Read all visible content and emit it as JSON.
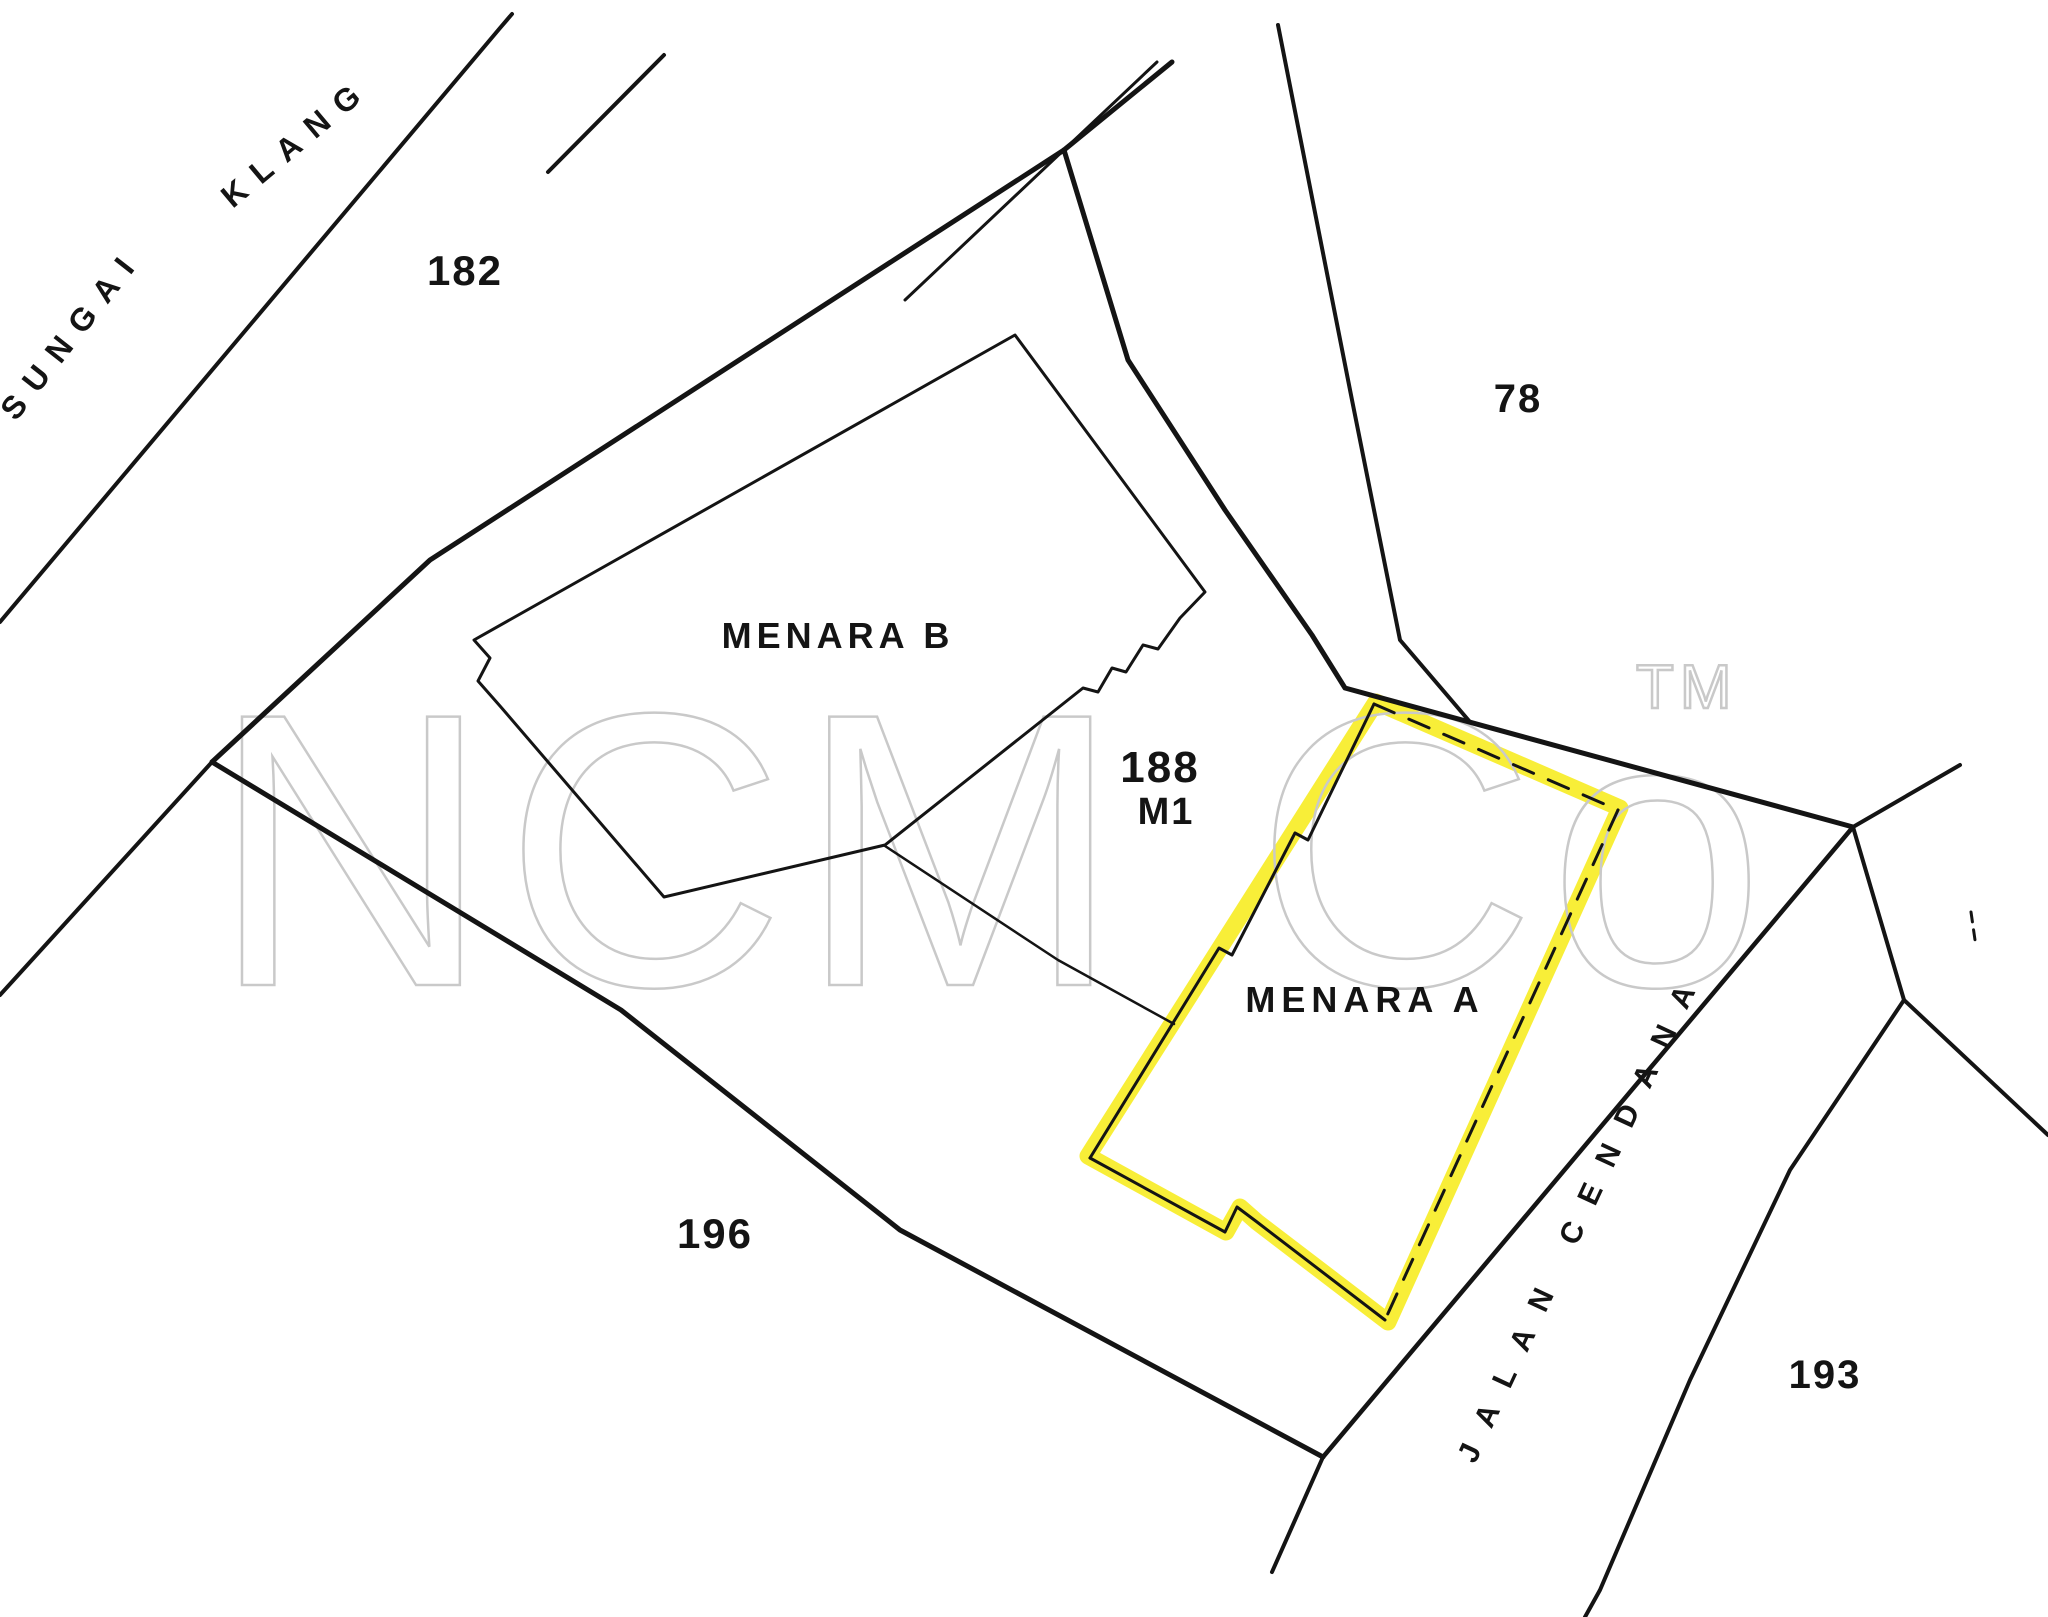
{
  "canvas": {
    "width": 2048,
    "height": 1617,
    "background": "#ffffff",
    "line_color": "#141414",
    "highlight_color": "#f7ec1c",
    "watermark_color": "#c9c9c9"
  },
  "watermark": {
    "text": "NCM Co",
    "tm_text": "TM"
  },
  "map": {
    "highlight": {
      "name": "menara-a-highlight",
      "color": "#f7ec1c",
      "width": 17,
      "opacity": 0.88,
      "closed": true,
      "points": [
        [
          1376,
          702
        ],
        [
          1620,
          808
        ],
        [
          1388,
          1322
        ],
        [
          1257,
          1222
        ],
        [
          1240,
          1207
        ],
        [
          1226,
          1232
        ],
        [
          1088,
          1156
        ]
      ]
    },
    "lines": [
      {
        "name": "river-bank-north",
        "width": 4,
        "points": [
          [
            0,
            622
          ],
          [
            500,
            28
          ],
          [
            512,
            14
          ]
        ]
      },
      {
        "name": "river-bank-stroke",
        "width": 4,
        "points": [
          [
            548,
            172
          ],
          [
            664,
            55
          ]
        ]
      },
      {
        "name": "river-bank-south",
        "width": 4,
        "points": [
          [
            212,
            762
          ],
          [
            0,
            995
          ]
        ]
      },
      {
        "name": "parcel-boundary-nw",
        "width": 5,
        "points": [
          [
            212,
            762
          ],
          [
            430,
            560
          ],
          [
            1064,
            150
          ]
        ]
      },
      {
        "name": "parcel-boundary-top-spur",
        "width": 5,
        "points": [
          [
            1064,
            150
          ],
          [
            1172,
            62
          ]
        ]
      },
      {
        "name": "thin-parallel-top",
        "width": 3,
        "points": [
          [
            905,
            300
          ],
          [
            1157,
            62
          ]
        ]
      },
      {
        "name": "parcel-boundary-ne",
        "width": 5,
        "points": [
          [
            1064,
            150
          ],
          [
            1128,
            360
          ],
          [
            1225,
            510
          ],
          [
            1312,
            635
          ],
          [
            1345,
            688
          ],
          [
            1853,
            827
          ]
        ]
      },
      {
        "name": "lot78-boundary",
        "width": 4,
        "points": [
          [
            1278,
            25
          ],
          [
            1352,
            400
          ],
          [
            1400,
            640
          ],
          [
            1470,
            722
          ]
        ]
      },
      {
        "name": "parcel-boundary-south",
        "width": 5,
        "points": [
          [
            212,
            762
          ],
          [
            621,
            1010
          ],
          [
            900,
            1230
          ],
          [
            1323,
            1457
          ]
        ]
      },
      {
        "name": "road-spur",
        "width": 4,
        "points": [
          [
            1323,
            1457
          ],
          [
            1272,
            1572
          ]
        ]
      },
      {
        "name": "road-nw-edge",
        "width": 4.5,
        "points": [
          [
            1323,
            1457
          ],
          [
            1853,
            827
          ]
        ]
      },
      {
        "name": "junction-arm-northeast",
        "width": 4,
        "points": [
          [
            1853,
            827
          ],
          [
            1960,
            765
          ]
        ]
      },
      {
        "name": "junction-link",
        "width": 4,
        "points": [
          [
            1853,
            827
          ],
          [
            1904,
            1000
          ]
        ]
      },
      {
        "name": "junction-arm-east",
        "width": 4,
        "points": [
          [
            1904,
            1000
          ],
          [
            2048,
            1135
          ]
        ]
      },
      {
        "name": "road-se-edge",
        "width": 4,
        "points": [
          [
            1904,
            1000
          ],
          [
            1790,
            1170
          ],
          [
            1690,
            1380
          ],
          [
            1600,
            1590
          ],
          [
            1585,
            1617
          ]
        ]
      },
      {
        "name": "survey-tick",
        "width": 3,
        "dash": "10 8",
        "points": [
          [
            1971,
            912
          ],
          [
            1975,
            940
          ]
        ]
      },
      {
        "name": "menara-b-outline",
        "width": 3,
        "closed": true,
        "points": [
          [
            474,
            640
          ],
          [
            490,
            658
          ],
          [
            478,
            681
          ],
          [
            500,
            706
          ],
          [
            664,
            897
          ],
          [
            885,
            845
          ],
          [
            1083,
            688
          ],
          [
            1098,
            692
          ],
          [
            1112,
            668
          ],
          [
            1126,
            672
          ],
          [
            1143,
            645
          ],
          [
            1158,
            649
          ],
          [
            1180,
            618
          ],
          [
            1205,
            592
          ],
          [
            1015,
            335
          ]
        ]
      },
      {
        "name": "menara-b-annex-line",
        "width": 2.5,
        "points": [
          [
            885,
            846
          ],
          [
            1058,
            960
          ],
          [
            1174,
            1024
          ]
        ]
      },
      {
        "name": "menara-a-outline-nw",
        "width": 3,
        "points": [
          [
            1374,
            704
          ],
          [
            1308,
            840
          ],
          [
            1295,
            833
          ],
          [
            1232,
            955
          ],
          [
            1219,
            948
          ],
          [
            1090,
            1158
          ]
        ]
      },
      {
        "name": "menara-a-outline-bottom",
        "width": 3,
        "points": [
          [
            1090,
            1158
          ],
          [
            1225,
            1232
          ],
          [
            1237,
            1207
          ],
          [
            1257,
            1222
          ],
          [
            1385,
            1320
          ]
        ]
      },
      {
        "name": "menara-a-outline-ne-dashed",
        "width": 3,
        "dash": "22 16",
        "points": [
          [
            1374,
            704
          ],
          [
            1618,
            810
          ]
        ]
      },
      {
        "name": "menara-a-outline-se-dashed",
        "width": 3,
        "dash": "22 16",
        "points": [
          [
            1618,
            810
          ],
          [
            1385,
            1320
          ]
        ]
      }
    ],
    "labels": [
      {
        "name": "label-sungai",
        "text": "SUNGAI",
        "x": 80,
        "y": 340,
        "rotation": -52,
        "size": 32,
        "spacing": 14
      },
      {
        "name": "label-klang",
        "text": "KLANG",
        "x": 303,
        "y": 150,
        "rotation": -40,
        "size": 32,
        "spacing": 14
      },
      {
        "name": "label-lot-182",
        "text": "182",
        "x": 465,
        "y": 285,
        "rotation": 0,
        "size": 42,
        "spacing": 2
      },
      {
        "name": "label-lot-78",
        "text": "78",
        "x": 1518,
        "y": 412,
        "rotation": 0,
        "size": 40,
        "spacing": 2
      },
      {
        "name": "label-menara-b",
        "text": "MENARA B",
        "x": 838,
        "y": 648,
        "rotation": 0,
        "size": 36,
        "spacing": 5
      },
      {
        "name": "label-lot-188",
        "text": "188",
        "x": 1160,
        "y": 782,
        "rotation": 0,
        "size": 44,
        "spacing": 2
      },
      {
        "name": "label-lot-188-m1",
        "text": "M1",
        "x": 1166,
        "y": 824,
        "rotation": 0,
        "size": 38,
        "spacing": 2
      },
      {
        "name": "label-menara-a",
        "text": "MENARA A",
        "x": 1365,
        "y": 1012,
        "rotation": 0,
        "size": 36,
        "spacing": 6
      },
      {
        "name": "label-lot-196",
        "text": "196",
        "x": 715,
        "y": 1248,
        "rotation": 0,
        "size": 42,
        "spacing": 2
      },
      {
        "name": "label-lot-193",
        "text": "193",
        "x": 1825,
        "y": 1388,
        "rotation": 0,
        "size": 40,
        "spacing": 2
      },
      {
        "name": "label-jalan-cendana",
        "text": "JALAN CENDANA",
        "x": 1590,
        "y": 1218,
        "rotation": -65,
        "size": 30,
        "spacing": 22
      }
    ]
  }
}
